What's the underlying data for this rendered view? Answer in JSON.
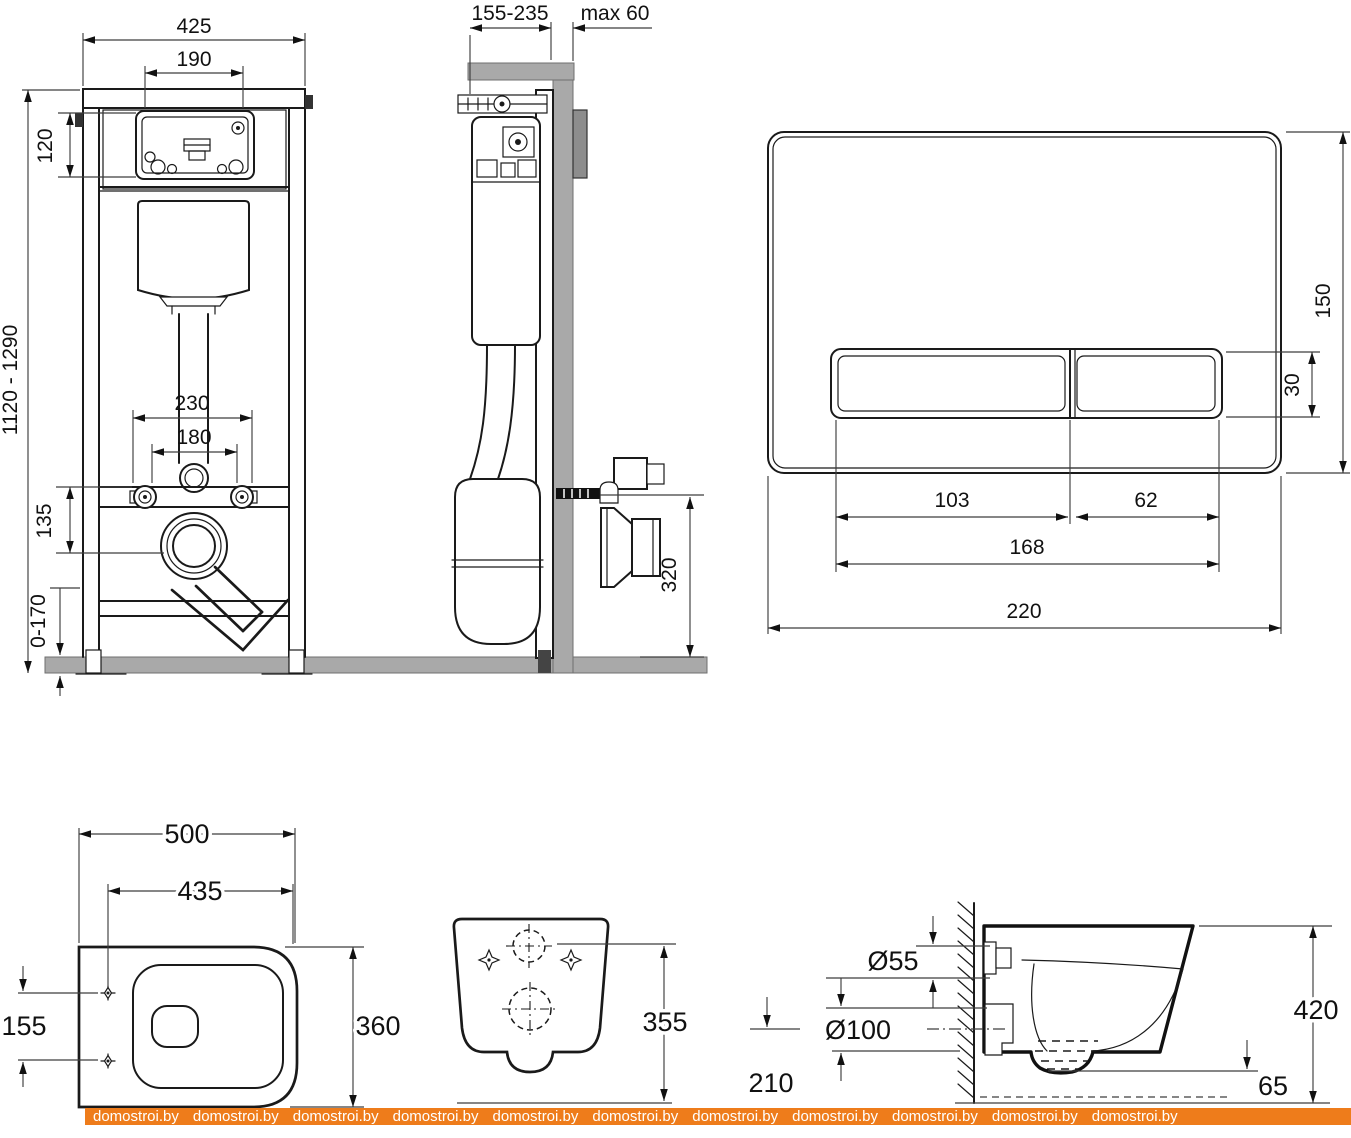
{
  "watermark": {
    "label": "domostroi.by",
    "count": 11
  },
  "colors": {
    "accent_orange": "#ee7c1b",
    "drawing_line": "#1a1a1a",
    "dimension_line": "#3d3d3d",
    "material_gray": "#a9a9a9"
  },
  "dimensions": {
    "frame_front": {
      "total_width": "425",
      "opening_width": "190",
      "opening_height": "120",
      "install_height_range": "1120 - 1290",
      "fixing_spacing_outer": "230",
      "fixing_spacing_inner": "180",
      "fixing_to_outlet": "135",
      "foot_adjustment": "0-170"
    },
    "frame_side": {
      "install_depth_range": "155-235",
      "finish_wall_max": "max 60",
      "outlet_height": "320"
    },
    "flush_plate": {
      "plate_height": "150",
      "button_height": "30",
      "large_button_width": "103",
      "small_button_width": "62",
      "buttons_total_width": "168",
      "plate_width": "220"
    },
    "bowl_top": {
      "bowl_length": "500",
      "seat_length": "435",
      "bolt_spacing": "155",
      "bowl_width": "360"
    },
    "bowl_rear": {
      "bowl_height": "355"
    },
    "bowl_side": {
      "flush_inlet": "Ø55",
      "waste_outlet": "Ø100",
      "outlet_axis_height": "210",
      "rim_height": "420",
      "bottom_gap": "65"
    }
  }
}
